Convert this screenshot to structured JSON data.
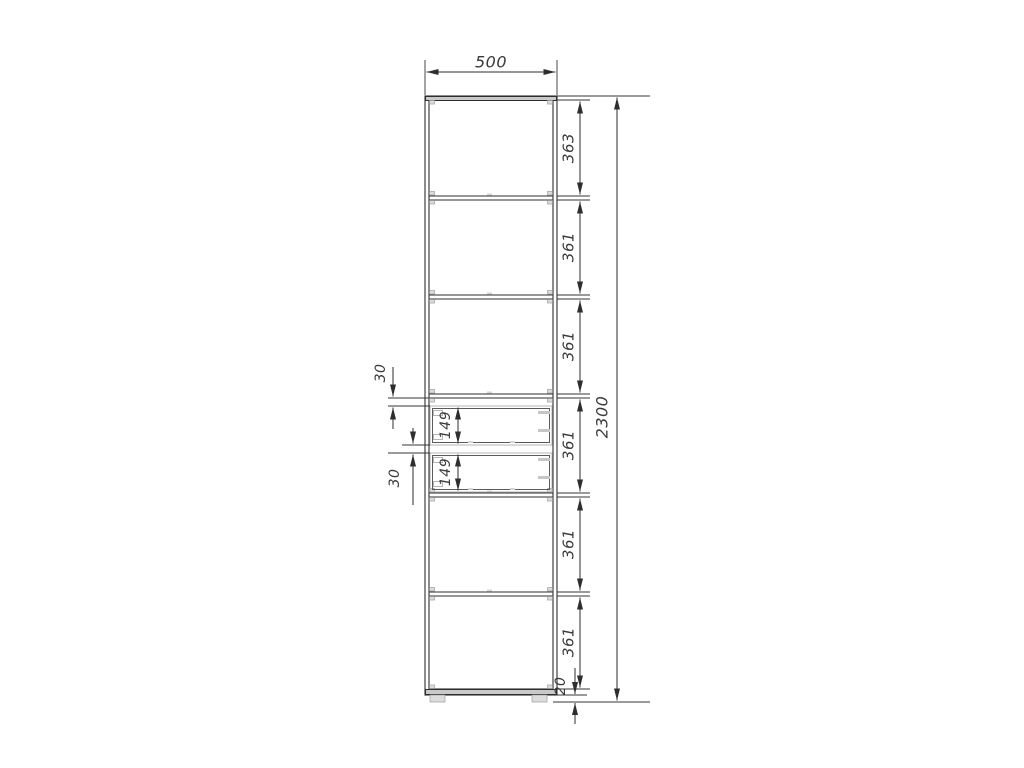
{
  "diagram": {
    "type": "furniture-dimension-drawing",
    "view": "cabinet-front-elevation",
    "labels": {
      "width": "500",
      "overall_height": "2300",
      "segments": [
        "363",
        "361",
        "361",
        "361",
        "361",
        "361"
      ],
      "drawer_gap_top": "30",
      "drawer_front_1": "149",
      "drawer_gap_middle": "30",
      "drawer_front_2": "149",
      "plinth": "20"
    },
    "dimensions_mm": {
      "width": 500,
      "overall_height": 2300,
      "section_heights": [
        363,
        361,
        361,
        361,
        361,
        361
      ],
      "drawer_top_gap": 30,
      "drawer_front_height": 149,
      "drawer_middle_gap": 30,
      "plinth_height": 20
    },
    "colors": {
      "background": "#ffffff",
      "outline": "#2e2e2e",
      "dimension_text": "#3a3a3a",
      "panel_fill": "#c9c9c9",
      "hardware": "#b5b5b5"
    }
  }
}
